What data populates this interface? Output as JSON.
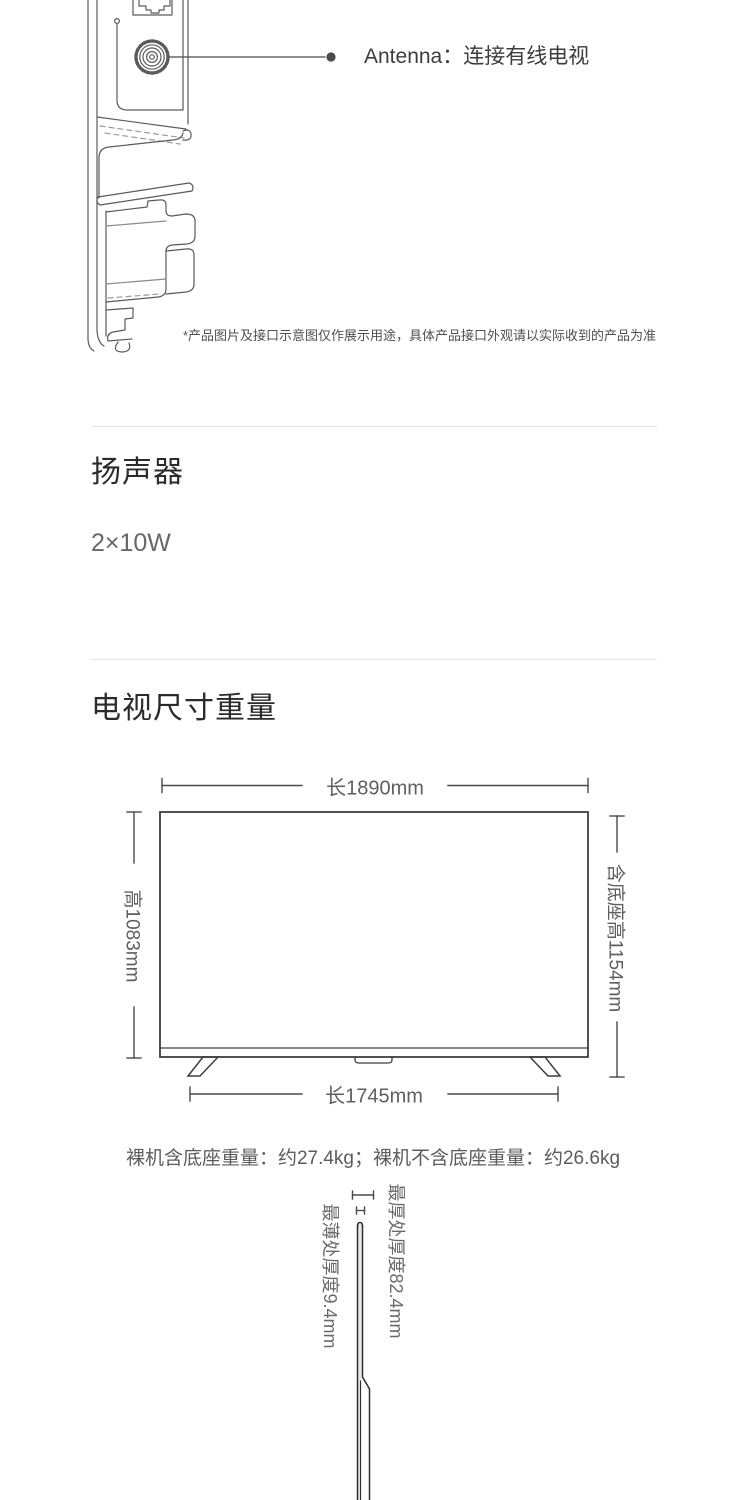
{
  "page": {
    "background_color": "#ffffff",
    "line_art_color": "#5a5a5a",
    "diagram_line_color": "#3f3f3f",
    "text_gray": "#5f5f5f",
    "divider_color": "#e4e4e4"
  },
  "ports_section": {
    "antenna_label": "Antenna：连接有线电视",
    "disclaimer": "*产品图片及接口示意图仅作展示用途，具体产品接口外观请以实际收到的产品为准",
    "icons": [
      "ethernet-port-icon",
      "antenna-coax-port-icon",
      "callout-dot"
    ]
  },
  "speaker_section": {
    "title": "扬声器",
    "value": "2×10W"
  },
  "size_section": {
    "title": "电视尺寸重量",
    "dimensions": {
      "width_label": "长1890mm",
      "height_label": "高1083mm",
      "height_with_stand_label": "含底座高1154mm",
      "stand_width_label": "长1745mm"
    },
    "weight_note": "裸机含底座重量：约27.4kg；裸机不含底座重量：约26.6kg",
    "thickness": {
      "thinnest_label": "最薄处厚度9.4mm",
      "thickest_label": "最厚处厚度82.4mm"
    }
  }
}
